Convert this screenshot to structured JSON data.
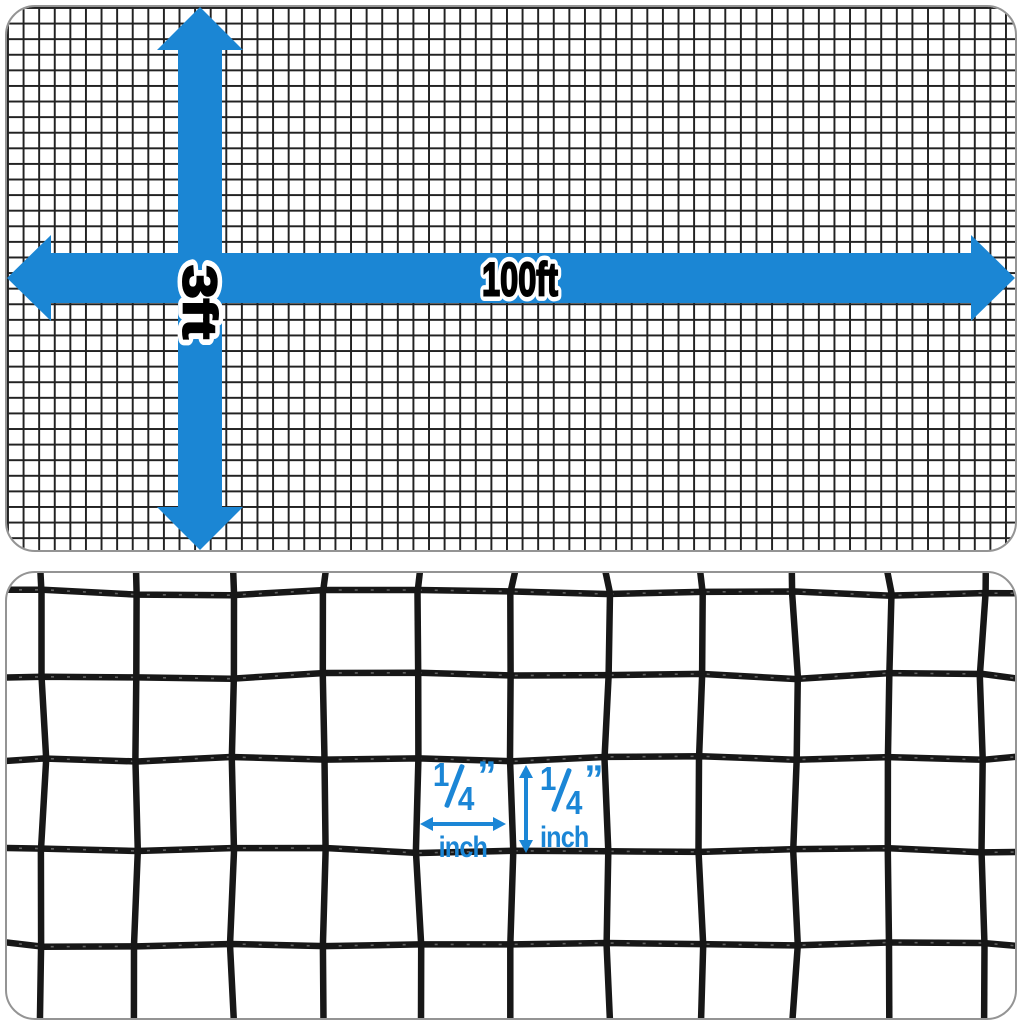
{
  "colors": {
    "arrow_blue": "#1b86d4",
    "label_blue": "#1b86d6",
    "wire_black": "#171717",
    "fine_grid": "#222222",
    "panel_border": "#949494",
    "text_black": "#000000",
    "text_outline": "#ffffff"
  },
  "top_panel": {
    "width_label": "100ft",
    "height_label": "3ft"
  },
  "bottom_panel": {
    "opening_width": {
      "numerator": "1",
      "denominator": "4",
      "quote": "”",
      "unit": "inch"
    },
    "opening_height": {
      "numerator": "1",
      "denominator": "4",
      "quote": "”",
      "unit": "inch"
    }
  }
}
